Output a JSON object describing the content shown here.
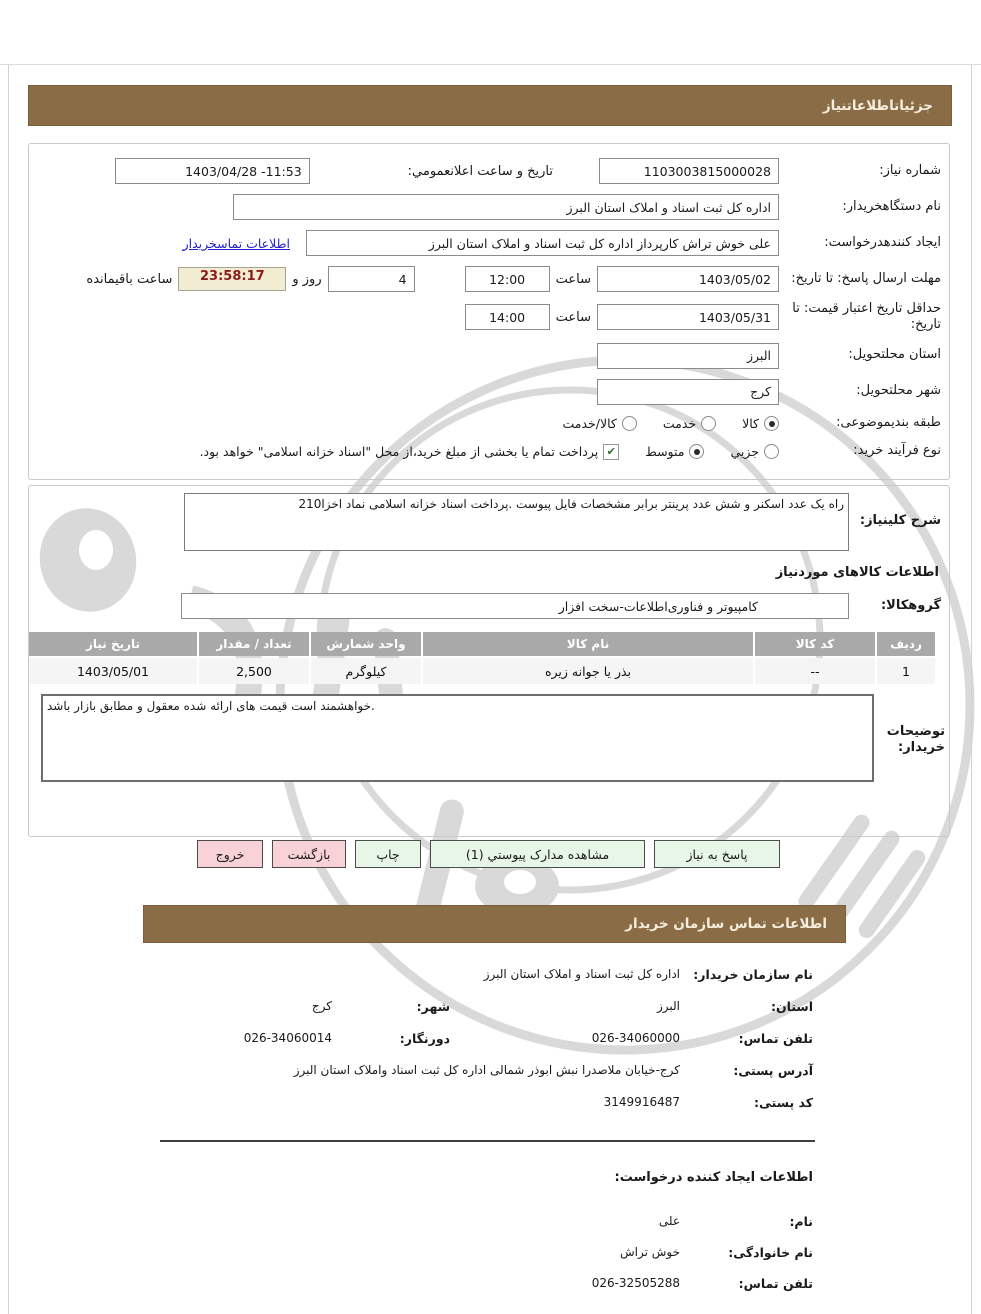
{
  "page": {
    "title_bar": "جزئیاتاطلاعاتنیاز",
    "contact_bar": "اطلاعات تماس سازمان خریدار"
  },
  "icons": {
    "check": "✔"
  },
  "form": {
    "need_number": {
      "label": "شماره نیاز:",
      "value": "1103003815000028"
    },
    "announce": {
      "label": "تاریخ و ساعت اعلانعمومي:",
      "value": "1403/04/28 -11:53"
    },
    "buyer_org": {
      "label": "نام دستگاهخریدار:",
      "value": "اداره کل ثبت اسناد و املاک استان البرز"
    },
    "creator": {
      "label": "ایجاد کنندهدرخواست:",
      "value": "علی خوش تراش کارپرداز اداره کل ثبت اسناد و املاک استان البرز",
      "link": "اطلاعات تماسخریدار"
    },
    "reply_deadline": {
      "label": "مهلت ارسال پاسخ: تا تاریخ:",
      "date": "1403/05/02",
      "time_label": "ساعت",
      "time": "12:00",
      "days": "4",
      "days_label": "روز و",
      "countdown": "23:58:17",
      "countdown_label": "ساعت باقیمانده"
    },
    "price_validity": {
      "label": "حداقل تاریخ اعتبار قیمت: تا تاریخ:",
      "date": "1403/05/31",
      "time_label": "ساعت",
      "time": "14:00"
    },
    "delivery_province": {
      "label": "استان محلتحویل:",
      "value": "البرز"
    },
    "delivery_city": {
      "label": "شهر محلتحویل:",
      "value": "کرج"
    },
    "subject_class": {
      "label": "طبقه بندیموضوعی:",
      "options": [
        {
          "label": "کالا",
          "selected": true
        },
        {
          "label": "خدمت",
          "selected": false
        },
        {
          "label": "کالا/خدمت",
          "selected": false
        }
      ]
    },
    "purchase_process": {
      "label": "نوع فرآیند خرید:",
      "options": [
        {
          "label": "جزیي",
          "selected": false
        },
        {
          "label": "متوسط",
          "selected": true
        }
      ],
      "checkbox": {
        "label": "پرداخت تمام یا بخشی از مبلغ خرید،از محل \"اسناد خزانه اسلامی\" خواهد بود.",
        "checked": true
      }
    }
  },
  "need_description": {
    "label": "شرح کلینیاز:",
    "value": "راه یک عدد اسکنر و شش عدد پرینتر برابر مشخصات فایل پیوست .پرداخت اسناد خزانه اسلامی نماد اخزا210"
  },
  "goods_section": {
    "title": "اطلاعات کالاهای موردنیاز",
    "group": {
      "label": "گروهکالا:",
      "value": "کامپیوتر و فناوری‌اطلاعات-سخت افزار"
    }
  },
  "goods_table": {
    "headers": [
      "ردیف",
      "کد کالا",
      "نام کالا",
      "واحد شمارش",
      "تعداد / مقدار",
      "تاریخ نیاز"
    ],
    "rows": [
      [
        "1",
        "--",
        "بذر یا جوانه زیره",
        "کیلوگرم",
        "2,500",
        "1403/05/01"
      ]
    ]
  },
  "buyer_notes": {
    "label": "توضیحات خریدار:",
    "value": "خواهشمند است قیمت های ارائه شده معقول و مطابق بازار باشد."
  },
  "buttons": [
    {
      "label": "پاسخ به نیاز"
    },
    {
      "label": "مشاهده مدارک پیوستي (1)"
    },
    {
      "label": "چاپ"
    },
    {
      "label": "بازگشت"
    },
    {
      "label": "خروج"
    }
  ],
  "contact": {
    "org_name": {
      "label": "نام سازمان خریدار:",
      "value": "اداره کل ثبت اسناد و املاک استان البرز"
    },
    "province": {
      "label": "استان:",
      "value": "البرز"
    },
    "city": {
      "label": "شهر:",
      "value": "کرج"
    },
    "phone": {
      "label": "تلفن تماس:",
      "value": "026-34060000"
    },
    "fax": {
      "label": "دورنگار:",
      "value": "026-34060014"
    },
    "address": {
      "label": "آدرس پستی:",
      "value": "کرج-خیابان ملاصدرا نبش ابوذر شمالی اداره کل ثبت اسناد واملاک استان البرز"
    },
    "postal_code": {
      "label": "کد پستی:",
      "value": "3149916487"
    },
    "creator_title": "اطلاعات ایجاد کننده درخواست:",
    "first_name": {
      "label": "نام:",
      "value": "علی"
    },
    "last_name": {
      "label": "نام خانوادگی:",
      "value": "خوش تراش"
    },
    "creator_phone": {
      "label": "تلفن تماس:",
      "value": "026-32505288"
    }
  },
  "colors": {
    "header_brown": "#8a6c47",
    "table_header_gray": "#a9a9a9",
    "timer_bg": "#f1ecd2",
    "timer_text": "#8b1a1a",
    "button_green": "#e7f6e7",
    "button_pink": "#f9d2d8",
    "link_blue": "#2323cc"
  }
}
